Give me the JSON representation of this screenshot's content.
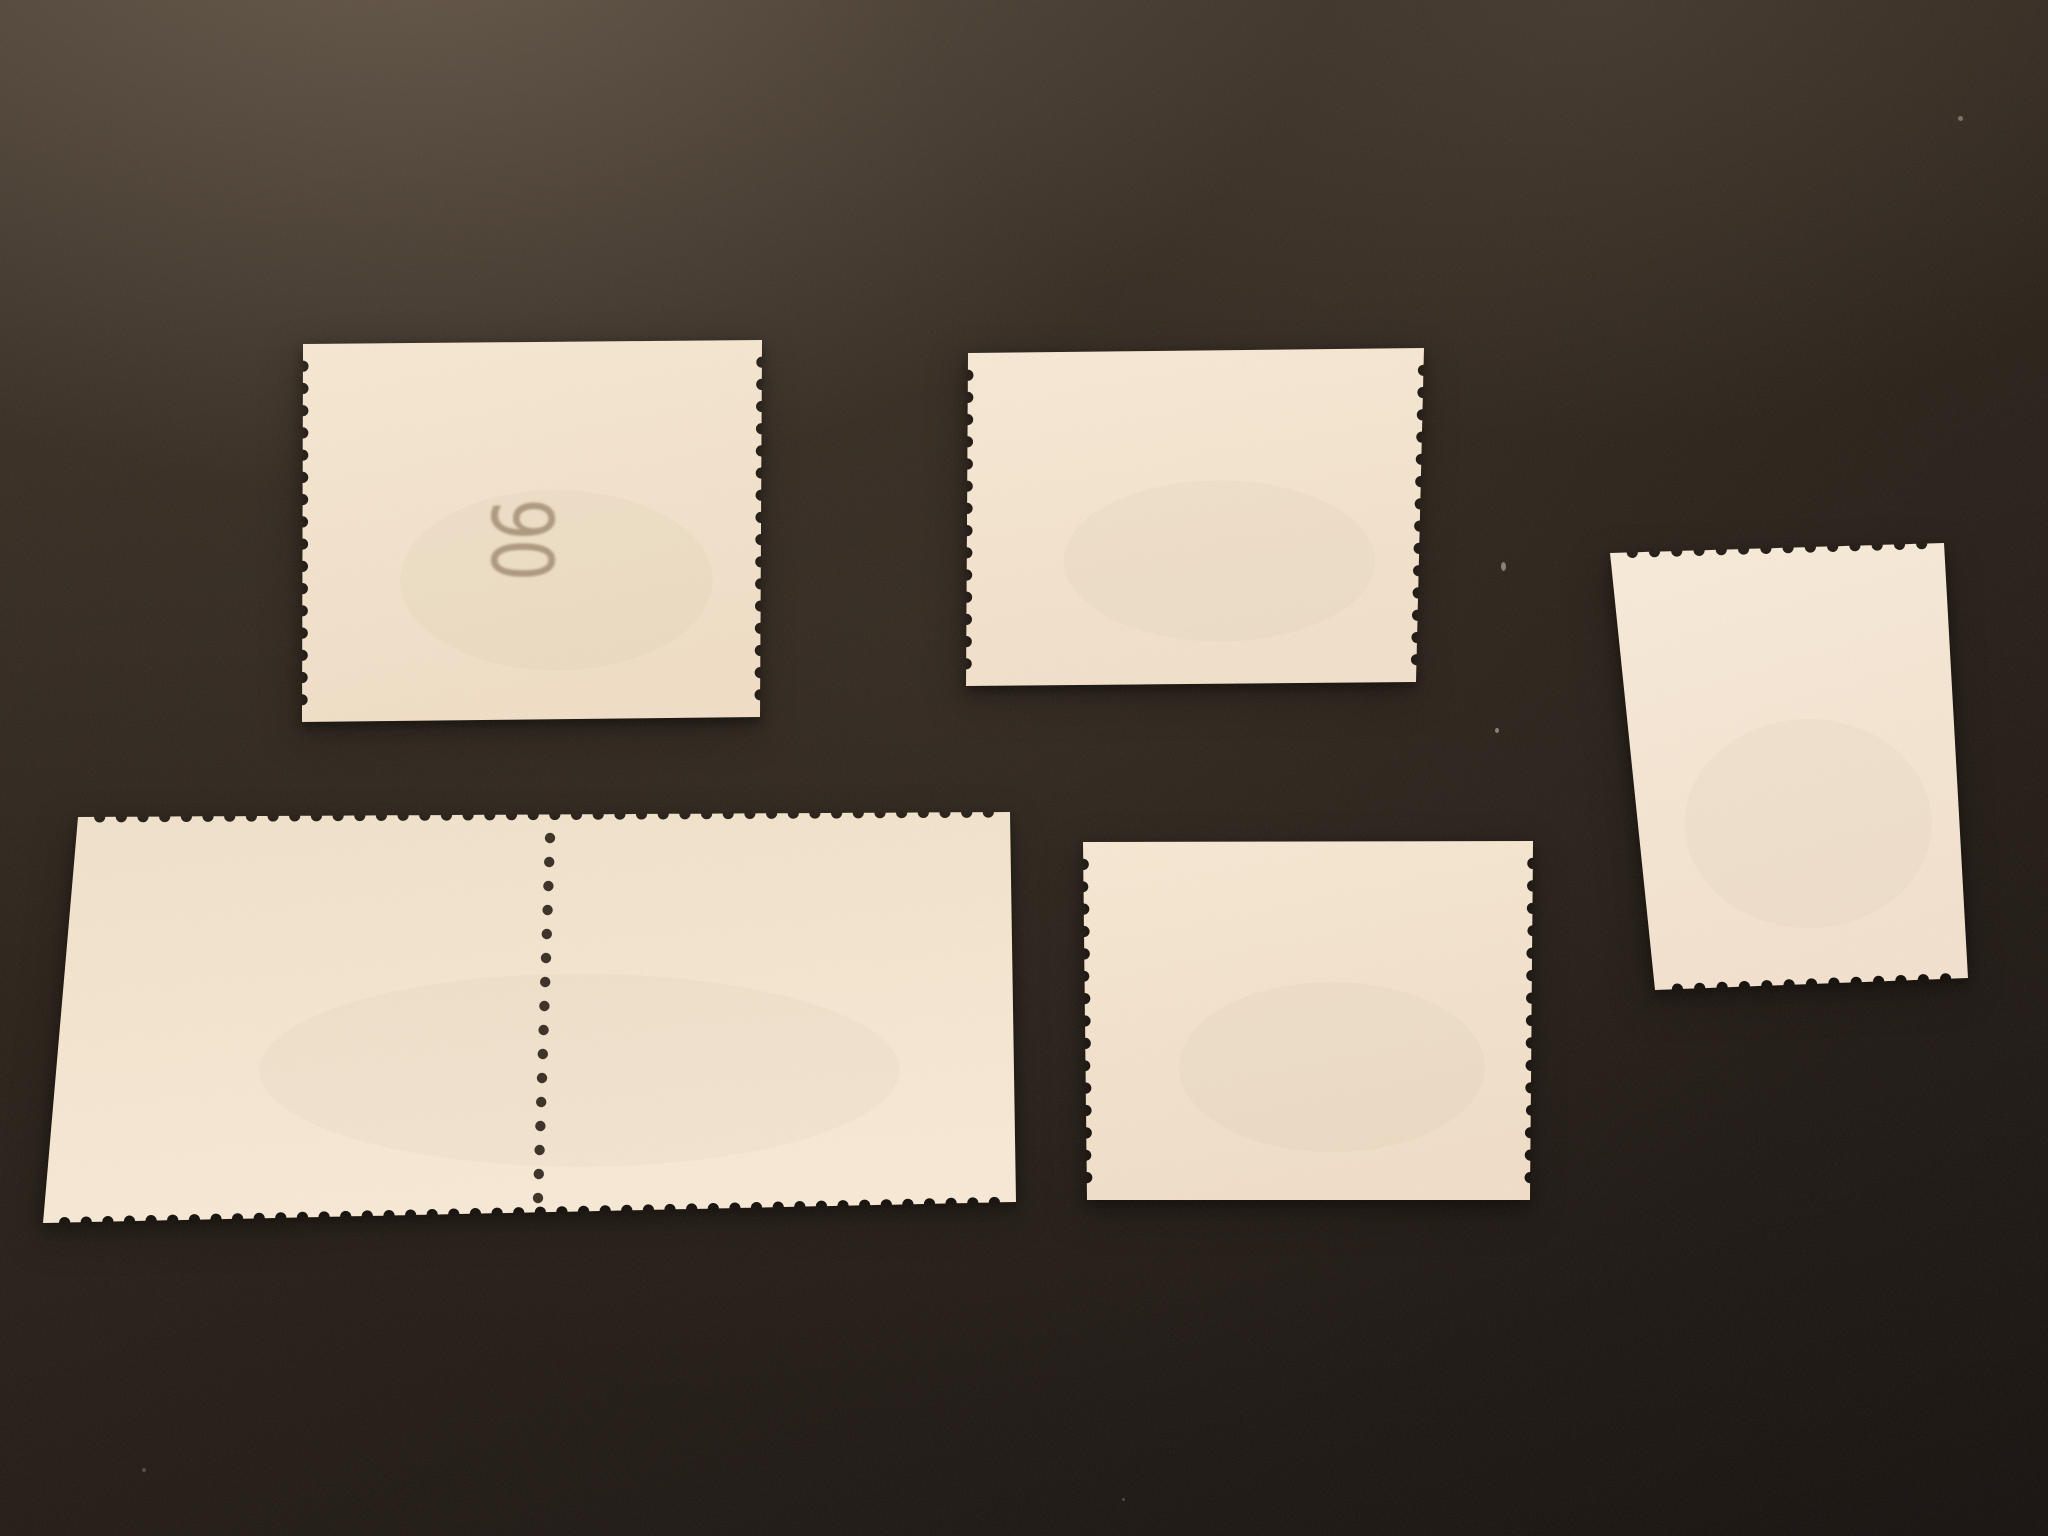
{
  "scene": {
    "title": "Backs of five blank cream postage stamps laid on a dark surface",
    "surface_color": "#2b231c",
    "paper_color": "#f4e6d1",
    "control_number_color": "#a18a72"
  },
  "stamps": [
    {
      "name": "top-left-coil-stamp",
      "control_number": "90",
      "control_number_rotation_deg": 90,
      "perforated_edges": "left and right",
      "straight_edges": "top and bottom"
    },
    {
      "name": "top-middle-coil-stamp",
      "perforated_edges": "left and right",
      "straight_edges": "top and bottom"
    },
    {
      "name": "right-vertical-stamp",
      "perforated_edges": "top and bottom",
      "straight_edges": "left and right"
    },
    {
      "name": "bottom-left-stamp-pair",
      "perforated_edges": "top and bottom",
      "straight_edges": "left and right",
      "center_perforation_row": true,
      "center_perforation_holes": 16
    },
    {
      "name": "bottom-middle-coil-stamp",
      "perforated_edges": "left and right",
      "straight_edges": "top and bottom"
    }
  ]
}
